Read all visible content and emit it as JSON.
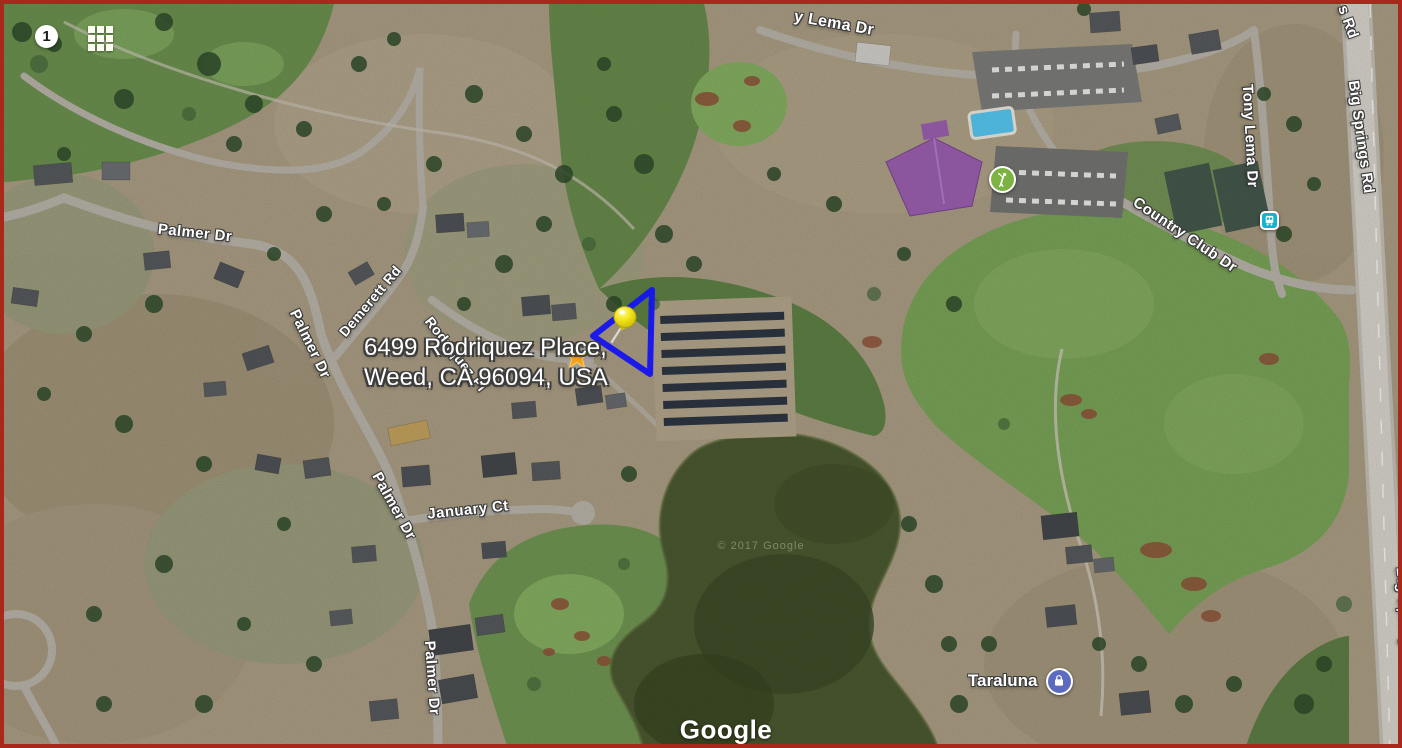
{
  "map": {
    "page_badge": "1",
    "attribution": "Google",
    "copyright": "© 2017 Google",
    "address_callout": {
      "line1": "6499 Rodriquez Place,",
      "line2": "Weed, CA 96094, USA"
    },
    "road_labels": [
      {
        "text": "Palmer Dr",
        "x": 191,
        "y": 229,
        "rot": 6,
        "size": 15,
        "under": false
      },
      {
        "text": "Demerett Rd",
        "x": 366,
        "y": 297,
        "rot": -50,
        "size": 14,
        "under": false
      },
      {
        "text": "Rodriquez Pl",
        "x": 452,
        "y": 350,
        "rot": 52,
        "size": 14,
        "under": true
      },
      {
        "text": "Palmer Dr",
        "x": 306,
        "y": 340,
        "rot": 64,
        "size": 15,
        "under": false
      },
      {
        "text": "Palmer Dr",
        "x": 390,
        "y": 502,
        "rot": 61,
        "size": 15,
        "under": false
      },
      {
        "text": "Palmer Dr",
        "x": 428,
        "y": 674,
        "rot": 86,
        "size": 15,
        "under": false
      },
      {
        "text": "January Ct",
        "x": 464,
        "y": 506,
        "rot": -6,
        "size": 15,
        "under": false
      },
      {
        "text": "y Lema Dr",
        "x": 830,
        "y": 20,
        "rot": 10,
        "size": 16,
        "under": false
      },
      {
        "text": "Tony Lema Dr",
        "x": 1246,
        "y": 132,
        "rot": 87,
        "size": 15,
        "under": false
      },
      {
        "text": "Country Club Dr",
        "x": 1181,
        "y": 231,
        "rot": 34,
        "size": 15,
        "under": false
      },
      {
        "text": "s Rd",
        "x": 1344,
        "y": 18,
        "rot": 70,
        "size": 15,
        "under": false
      },
      {
        "text": "Big Springs Rd",
        "x": 1357,
        "y": 133,
        "rot": 82,
        "size": 15,
        "under": false
      },
      {
        "text": "Big Springs Rd",
        "x": 1401,
        "y": 620,
        "rot": 86,
        "size": 15,
        "under": false
      }
    ],
    "pois": [
      {
        "name": "golf-course",
        "icon": "golfer",
        "color": "#7cb342",
        "x": 998,
        "y": 175,
        "d": 27,
        "shape": "circle"
      },
      {
        "name": "bus-stop",
        "icon": "bus",
        "color": "#12b5cb",
        "x": 1265,
        "y": 216,
        "d": 19,
        "shape": "square"
      },
      {
        "name": "taraluna-lodging",
        "icon": "bag",
        "color": "#5c6bc0",
        "x": 1055,
        "y": 677,
        "d": 27,
        "shape": "circle",
        "label": "Taraluna"
      }
    ],
    "marker": {
      "type": "pushpin",
      "color": "#f3e618",
      "x": 621,
      "y": 313,
      "rot": 12
    },
    "star_marker": {
      "color": "#f6a21d",
      "x": 573,
      "y": 353,
      "r": 13
    },
    "parcel_outline": {
      "color": "#1414f0",
      "width": 6,
      "points": [
        [
          648,
          286
        ],
        [
          589,
          332
        ],
        [
          646,
          370
        ]
      ]
    }
  }
}
